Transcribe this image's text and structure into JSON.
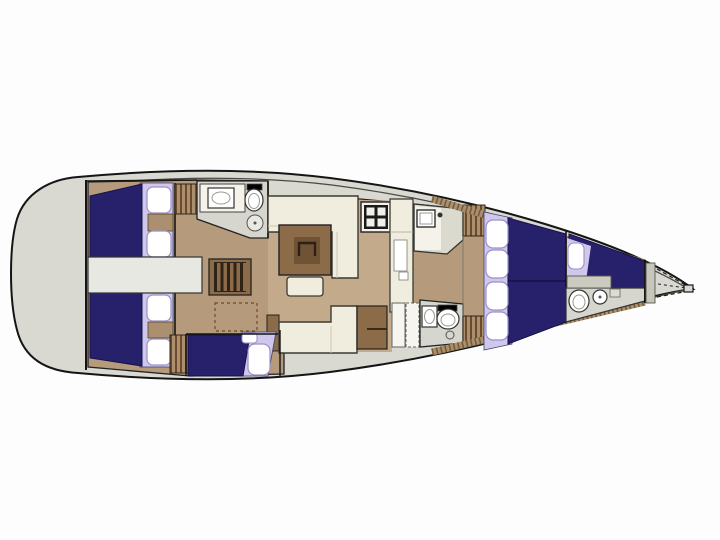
{
  "diagram": {
    "type": "yacht-interior-floorplan",
    "orientation": "bow-right",
    "background": "#fdfdfd"
  },
  "colors": {
    "hull_deck": "#d9d9d2",
    "outline": "#151515",
    "inner_line": "#4a4a44",
    "floor": "#b59a7c",
    "floor_light": "#c3aa8b",
    "berth": "#27206b",
    "berth_line": "#17114a",
    "bedding_trim": "#cfc8ec",
    "pillow": "#ffffff",
    "pillow_trim": "#9a90c8",
    "upholstery": "#f0edde",
    "upholstery_line": "#3b3b33",
    "wood": "#8c6b48",
    "wood_dark": "#6f5334",
    "wood_step": "#2e2317",
    "wet_room": "#d6d6ce",
    "fixture_white": "#ffffff",
    "engine_space": "#e8e8e2",
    "counter": "#dadacf",
    "counter_white": "#f4f2e9",
    "hatch_base": "#ab9070",
    "hatch_line": "#6b4b2b",
    "shelf_hatch": "#7a5a38"
  },
  "areas": [
    "aft-deck-transom",
    "aft-cabin-port",
    "aft-cabin-starboard",
    "aft-head-port",
    "engine-space",
    "companionway-steps",
    "salon",
    "galley",
    "navigation-station",
    "third-cabin-berth",
    "forward-head-starboard",
    "owner-cabin-v-berth",
    "bow-crew-cabin",
    "bow-head",
    "anchor-locker"
  ],
  "fixtures": [
    "double-berth",
    "single-berth",
    "pillows",
    "wardrobe",
    "sink",
    "toilet",
    "shower",
    "stove",
    "fridge-cabinet",
    "salon-table",
    "settee",
    "bench",
    "chart-table",
    "steps",
    "bow-fitting"
  ]
}
